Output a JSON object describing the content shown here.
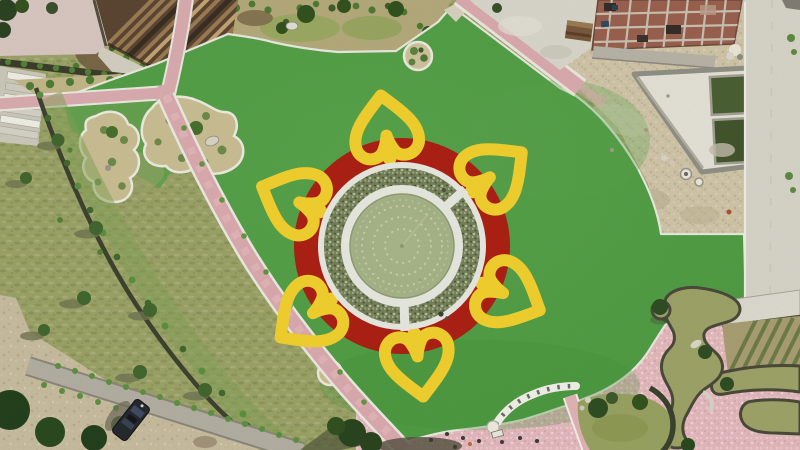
{
  "scene": {
    "type": "aerial-photo",
    "description": "Top-down drone photo of a landscaped park: a circular fountain pond ringed by a planted flower bed and a red disc with six yellow heart-shaped petal outlines laid out on a bright green lawn; wooden pergola upper-left, construction site with twin green water tanks upper-right, pink walkways, free-form ponds lower-right, dirt road with a parked vehicle lower-left.",
    "time_of_day": "daytime"
  },
  "colors": {
    "lawn_green": "#4f9a43",
    "lawn_green_light": "#58a24b",
    "flower_red": "#ab2114",
    "petal_yellow": "#f0cf2e",
    "pond_water": "#a9b68a",
    "pond_water_edge": "#b7c197",
    "planting_ring": "#75815a",
    "ring_white": "#e6e7df",
    "path_pink": "#d9a9ad",
    "plaza_pink": "#e2b8bc",
    "sand_tan": "#cfc4a7",
    "concrete_gray": "#d6d3c7",
    "construction_pool_green": "#4b5f33",
    "stream_olive": "#9da268",
    "natural_grass_olive": "#9aa268",
    "dirt_tan": "#c7bb9e",
    "road_gray": "#b2aea1",
    "hedge_dark": "#3e4330",
    "tree_green": "#2f4d22",
    "berm_tan": "#b3a97b",
    "pergola_wood": "#9a7a52"
  },
  "flower": {
    "center_x": 402,
    "center_y": 246,
    "red_disc_radius": 108,
    "outer_ring_radius": 84,
    "planting_ring_radius": 78,
    "walkway_radius": 61,
    "pond_radius": 52,
    "petals": {
      "count": 6,
      "angles_deg": [
        -8,
        52,
        115,
        172,
        233,
        293
      ],
      "radial_offset": 116
    },
    "fountain_ring_radii": [
      17,
      29,
      40,
      46
    ],
    "ring_gap_angles_deg": [
      48,
      178
    ]
  },
  "features": {
    "pergola": "wooden slat shade structure, top left",
    "stairs": "six-step staircase, upper left",
    "construction_site": "building floor slab and twin green water tanks, top right",
    "vehicle": "dark SUV parked on the dirt road, bottom left",
    "ponds": "free-form olive ponds and stream channels, bottom right",
    "islands": "planted islands with shrubs and rocks on the lawn"
  },
  "counts": {
    "petals": 6,
    "planted_islands": 4,
    "construction_pools": 2,
    "stair_steps": 6,
    "fountain_rings": 4,
    "vehicles": 1
  }
}
